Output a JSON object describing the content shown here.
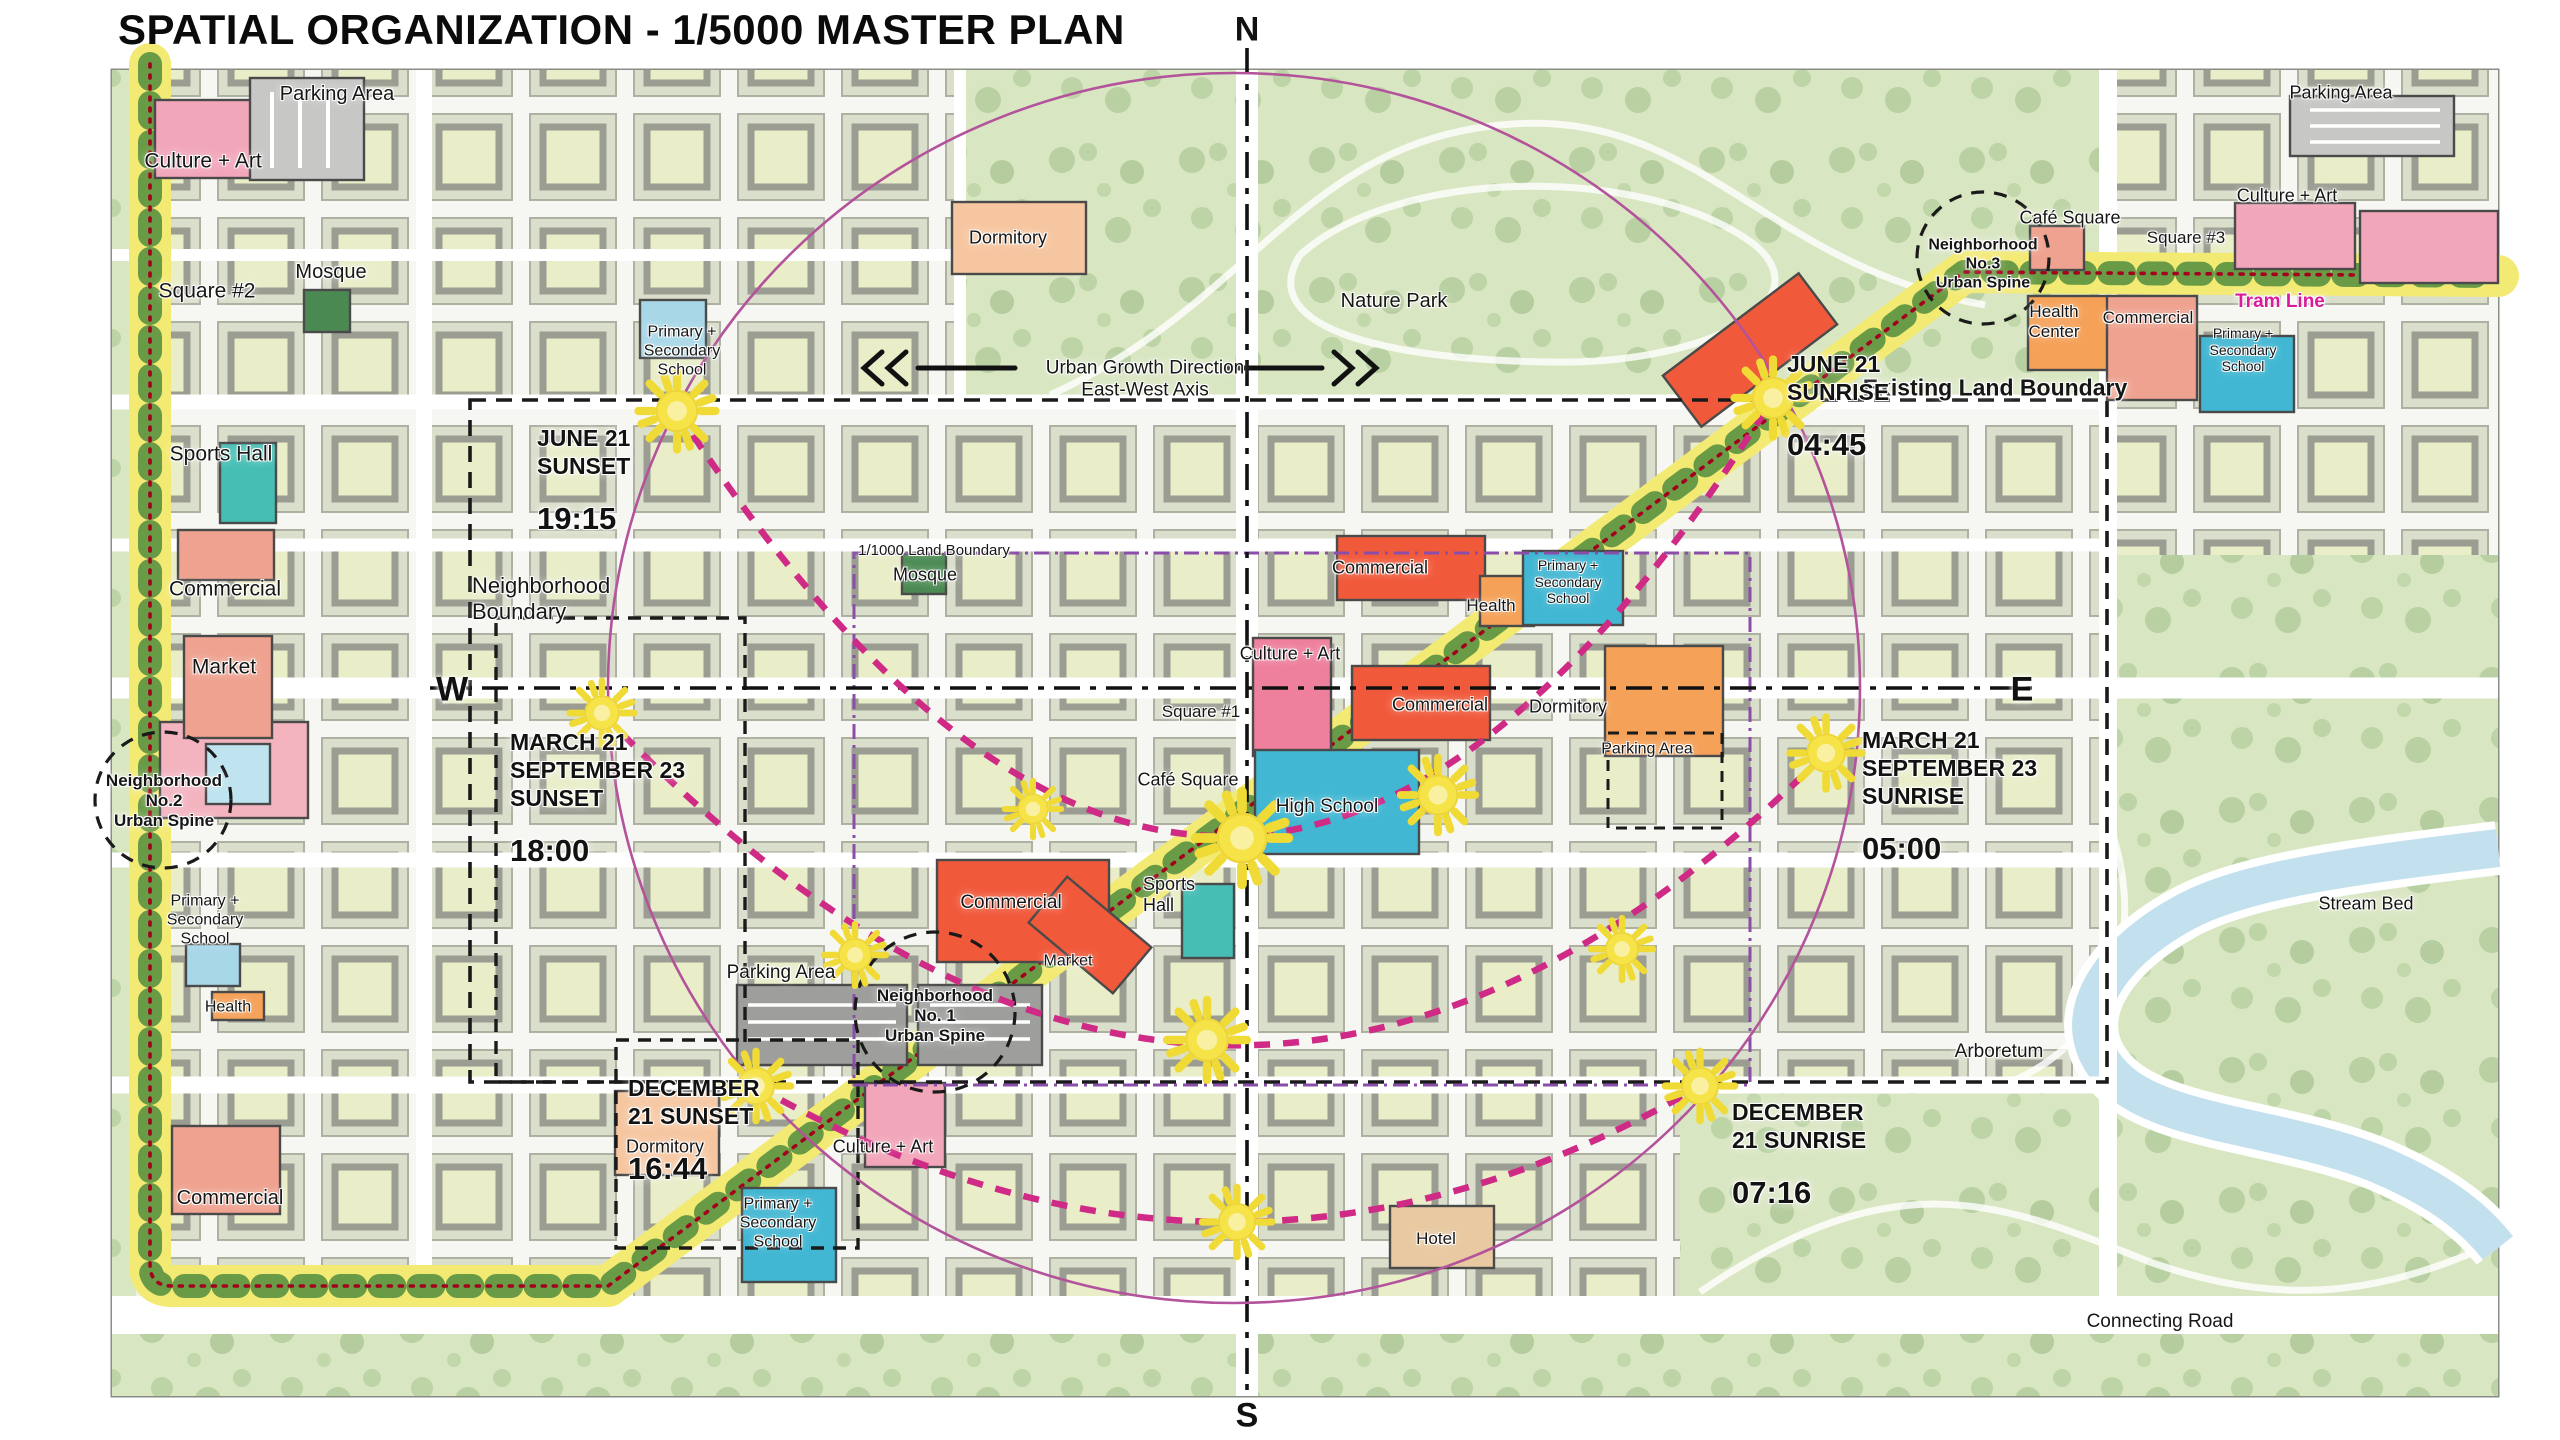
{
  "title": "SPATIAL ORGANIZATION - 1/5000 MASTER PLAN",
  "compass": {
    "north": "N",
    "south": "S",
    "west": "W",
    "east": "E"
  },
  "colors": {
    "sun_yellow": "#f5e348",
    "spine_yellow": "#f3ea74",
    "spine_green": "#5a9140",
    "tram_red": "#a3001d",
    "sun_path_magenta": "#cf2a85",
    "circle_purple": "#b3539b",
    "tram_line_text": "#d81b9b",
    "boundary_black": "#1a1a1a",
    "land_boundary_purple": "#8a4da8"
  },
  "map_labels": [
    {
      "id": "parking-area-nw",
      "text": "Parking Area",
      "x": 337,
      "y": 95,
      "size": 20
    },
    {
      "id": "culture-art-w",
      "text": "Culture + Art",
      "x": 203,
      "y": 162,
      "size": 21
    },
    {
      "id": "mosque-w",
      "text": "Mosque",
      "x": 331,
      "y": 273,
      "size": 20
    },
    {
      "id": "square-2",
      "text": "Square #2",
      "x": 207,
      "y": 292,
      "size": 21
    },
    {
      "id": "sports-hall-w",
      "text": "Sports Hall",
      "x": 221,
      "y": 455,
      "size": 21
    },
    {
      "id": "commercial-w",
      "text": "Commercial",
      "x": 225,
      "y": 590,
      "size": 21
    },
    {
      "id": "market-w",
      "text": "Market",
      "x": 224,
      "y": 668,
      "size": 21
    },
    {
      "id": "neighborhood-no2",
      "text": "Neighborhood\nNo.2\nUrban Spine",
      "x": 164,
      "y": 801,
      "size": 17,
      "bold": true
    },
    {
      "id": "school-w",
      "text": "Primary +\nSecondary\nSchool",
      "x": 205,
      "y": 921,
      "size": 16
    },
    {
      "id": "health-w",
      "text": "Health",
      "x": 228,
      "y": 1008,
      "size": 16
    },
    {
      "id": "commercial-sw",
      "text": "Commercial",
      "x": 230,
      "y": 1199,
      "size": 20
    },
    {
      "id": "school-nw",
      "text": "Primary +\nSecondary\nSchool",
      "x": 682,
      "y": 352,
      "size": 16
    },
    {
      "id": "neighborhood-boundary",
      "text": "Neighborhood\nBoundary",
      "x": 472,
      "y": 599,
      "size": 22,
      "align": "left"
    },
    {
      "id": "land-boundary-1000",
      "text": "1/1000 Land Boundary",
      "x": 934,
      "y": 551,
      "size": 15
    },
    {
      "id": "mosque-c",
      "text": "Mosque",
      "x": 925,
      "y": 575,
      "size": 18
    },
    {
      "id": "dormitory-n",
      "text": "Dormitory",
      "x": 1008,
      "y": 238,
      "size": 18
    },
    {
      "id": "nature-park",
      "text": "Nature Park",
      "x": 1394,
      "y": 302,
      "size": 20
    },
    {
      "id": "urban-growth-axis",
      "text": "Urban Growth Direction\nEast-West Axis",
      "x": 1145,
      "y": 380,
      "size": 19
    },
    {
      "id": "commercial-nc",
      "text": "Commercial",
      "x": 1380,
      "y": 568,
      "size": 18
    },
    {
      "id": "health-c",
      "text": "Health",
      "x": 1491,
      "y": 606,
      "size": 17
    },
    {
      "id": "school-c",
      "text": "Primary +\nSecondary\nSchool",
      "x": 1568,
      "y": 582,
      "size": 14
    },
    {
      "id": "culture-art-c",
      "text": "Culture + Art",
      "x": 1290,
      "y": 654,
      "size": 18
    },
    {
      "id": "square-1",
      "text": "Square #1",
      "x": 1201,
      "y": 712,
      "size": 17
    },
    {
      "id": "commercial-c",
      "text": "Commercial",
      "x": 1440,
      "y": 705,
      "size": 18
    },
    {
      "id": "dormitory-c",
      "text": "Dormitory",
      "x": 1568,
      "y": 707,
      "size": 18
    },
    {
      "id": "parking-area-e",
      "text": "Parking Area",
      "x": 1647,
      "y": 750,
      "size": 16
    },
    {
      "id": "cafe-square-c",
      "text": "Café Square",
      "x": 1188,
      "y": 780,
      "size": 18
    },
    {
      "id": "high-school",
      "text": "High School",
      "x": 1327,
      "y": 807,
      "size": 19
    },
    {
      "id": "sports-hall-c",
      "text": "Sports\nHall",
      "x": 1143,
      "y": 895,
      "size": 18,
      "align": "left"
    },
    {
      "id": "commercial-sc",
      "text": "Commercial",
      "x": 1011,
      "y": 903,
      "size": 19
    },
    {
      "id": "market-c",
      "text": "Market",
      "x": 1068,
      "y": 962,
      "size": 16
    },
    {
      "id": "parking-area-sw",
      "text": "Parking Area",
      "x": 781,
      "y": 973,
      "size": 19
    },
    {
      "id": "neighborhood-no1",
      "text": "Neighborhood\nNo. 1\nUrban Spine",
      "x": 935,
      "y": 1016,
      "size": 17,
      "bold": true
    },
    {
      "id": "dormitory-s",
      "text": "Dormitory",
      "x": 665,
      "y": 1147,
      "size": 18
    },
    {
      "id": "culture-art-s",
      "text": "Culture + Art",
      "x": 883,
      "y": 1147,
      "size": 18
    },
    {
      "id": "school-s",
      "text": "Primary +\nSecondary\nSchool",
      "x": 778,
      "y": 1224,
      "size": 16
    },
    {
      "id": "hotel",
      "text": "Hotel",
      "x": 1436,
      "y": 1239,
      "size": 17
    },
    {
      "id": "arboretum",
      "text": "Arboretum",
      "x": 1999,
      "y": 1052,
      "size": 19
    },
    {
      "id": "stream-bed",
      "text": "Stream Bed",
      "x": 2366,
      "y": 904,
      "size": 18
    },
    {
      "id": "connecting-road",
      "text": "Connecting Road",
      "x": 2160,
      "y": 1322,
      "size": 19
    },
    {
      "id": "existing-land-boundary",
      "text": "Existing Land Boundary",
      "x": 1995,
      "y": 388,
      "size": 23,
      "bold": true
    },
    {
      "id": "neighborhood-no3",
      "text": "Neighborhood\nNo.3\nUrban Spine",
      "x": 1983,
      "y": 265,
      "size": 16,
      "bold": true
    },
    {
      "id": "cafe-square-ne",
      "text": "Café Square",
      "x": 2070,
      "y": 218,
      "size": 18
    },
    {
      "id": "square-3",
      "text": "Square #3",
      "x": 2186,
      "y": 238,
      "size": 17
    },
    {
      "id": "culture-art-ne",
      "text": "Culture + Art",
      "x": 2287,
      "y": 196,
      "size": 18
    },
    {
      "id": "tram-line",
      "text": "Tram Line",
      "x": 2280,
      "y": 302,
      "size": 19,
      "bold": true,
      "color": "#d81b9b"
    },
    {
      "id": "health-center-ne",
      "text": "Health\nCenter",
      "x": 2054,
      "y": 322,
      "size": 17
    },
    {
      "id": "commercial-ne",
      "text": "Commercial",
      "x": 2148,
      "y": 318,
      "size": 17
    },
    {
      "id": "school-ne",
      "text": "Primary +\nSecondary\nSchool",
      "x": 2243,
      "y": 350,
      "size": 14
    },
    {
      "id": "parking-area-ne",
      "text": "Parking Area",
      "x": 2341,
      "y": 93,
      "size": 18
    }
  ],
  "sun_events": [
    {
      "id": "june21-sunset",
      "label": "JUNE 21\nSUNSET",
      "time": "19:15",
      "x": 537,
      "y": 404
    },
    {
      "id": "june21-sunrise",
      "label": "JUNE 21\nSUNRISE",
      "time": "04:45",
      "x": 1787,
      "y": 330
    },
    {
      "id": "equinox-sunset",
      "label": "MARCH 21\nSEPTEMBER 23\nSUNSET",
      "time": "18:00",
      "x": 510,
      "y": 708
    },
    {
      "id": "equinox-sunrise",
      "label": "MARCH 21\nSEPTEMBER 23\nSUNRISE",
      "time": "05:00",
      "x": 1862,
      "y": 706
    },
    {
      "id": "december21-sunset",
      "label": "DECEMBER\n21 SUNSET",
      "time": "16:44",
      "x": 628,
      "y": 1054
    },
    {
      "id": "december21-sunrise",
      "label": "DECEMBER\n21 SUNRISE",
      "time": "07:16",
      "x": 1732,
      "y": 1078
    }
  ],
  "suns": [
    {
      "x": 677,
      "y": 411,
      "r": 30
    },
    {
      "x": 1773,
      "y": 398,
      "r": 30
    },
    {
      "x": 602,
      "y": 713,
      "r": 25
    },
    {
      "x": 1826,
      "y": 753,
      "r": 28
    },
    {
      "x": 756,
      "y": 1086,
      "r": 27
    },
    {
      "x": 1700,
      "y": 1086,
      "r": 27
    },
    {
      "x": 1033,
      "y": 809,
      "r": 22
    },
    {
      "x": 1242,
      "y": 838,
      "r": 36
    },
    {
      "x": 1438,
      "y": 795,
      "r": 29
    },
    {
      "x": 1622,
      "y": 949,
      "r": 24
    },
    {
      "x": 855,
      "y": 955,
      "r": 24
    },
    {
      "x": 1207,
      "y": 1040,
      "r": 31
    },
    {
      "x": 1237,
      "y": 1222,
      "r": 27
    }
  ]
}
